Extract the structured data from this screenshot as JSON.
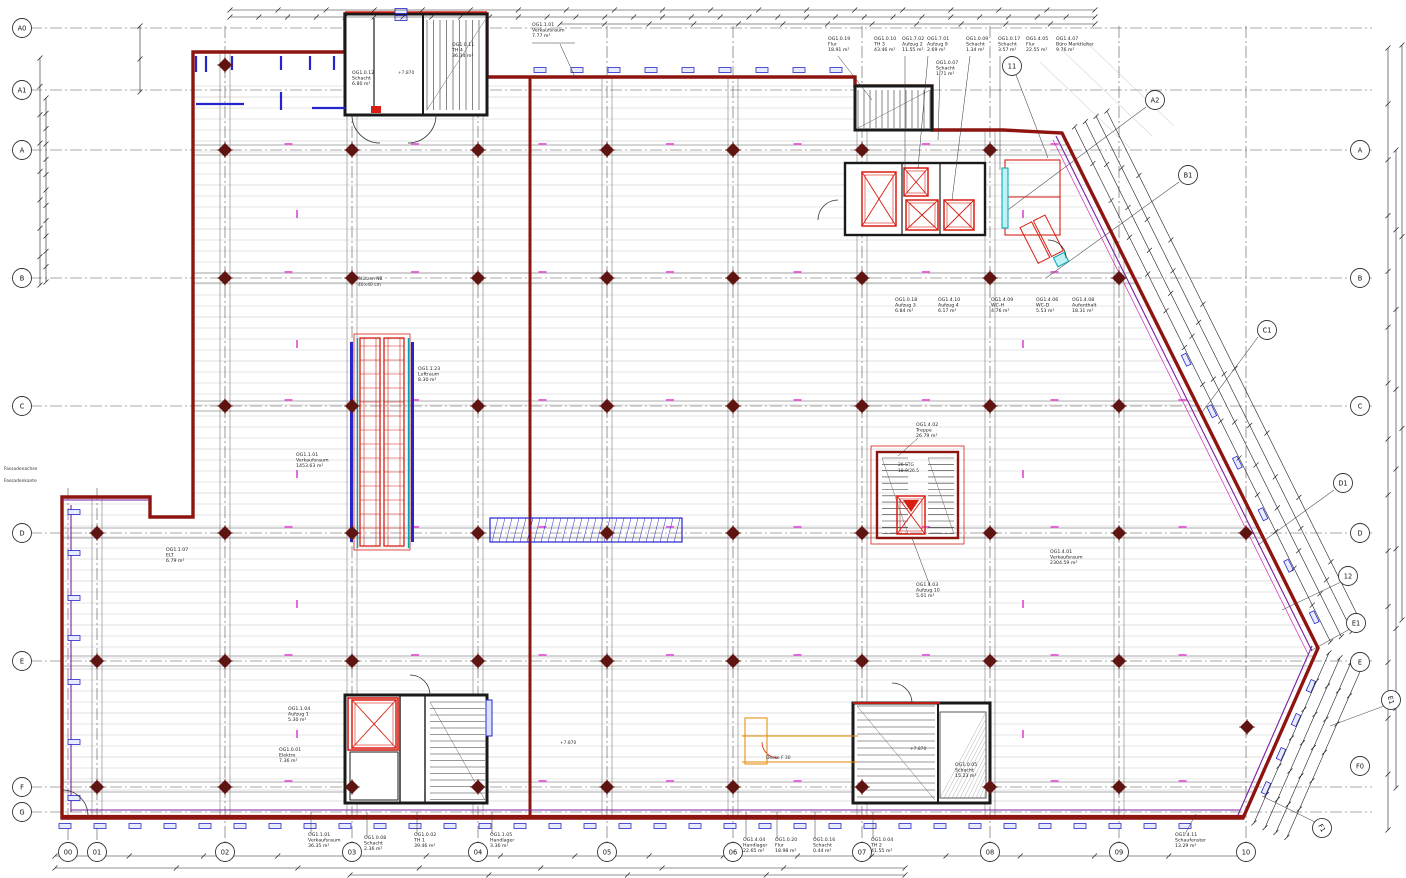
{
  "grid": {
    "left": [
      "A0",
      "A1",
      "A",
      "B",
      "C",
      "D",
      "E",
      "F",
      "G"
    ],
    "bottom": [
      "00",
      "01",
      "02",
      "03",
      "04",
      "05",
      "06",
      "07",
      "08",
      "09",
      "10"
    ],
    "right": [
      "A",
      "B",
      "C",
      "D",
      "E",
      "F0"
    ],
    "diag": [
      "A2",
      "B1",
      "C1",
      "D1",
      "12",
      "E1",
      "E1",
      "F1",
      "11"
    ]
  },
  "rooms": [
    {
      "id": "OG1.0.11",
      "name": "TH 4",
      "area": "36.34 m²"
    },
    {
      "id": "OG1.0.12",
      "name": "Schacht",
      "area": "6.80 m²"
    },
    {
      "id": "OG1.1.01",
      "name": "Verkaufsraum",
      "area": "7.77 m²"
    },
    {
      "id": "OG1.0.19",
      "name": "Flur",
      "area": "18.91 m²"
    },
    {
      "id": "OG1.0.10",
      "name": "TH 3",
      "area": "43.46 m²"
    },
    {
      "id": "OG1.7.02",
      "name": "Aufzug 2",
      "area": "11.55 m²"
    },
    {
      "id": "OG1.7.01",
      "name": "Aufzug 9",
      "area": "2.69 m²"
    },
    {
      "id": "OG1.0.07",
      "name": "Schacht",
      "area": "1.71 m²"
    },
    {
      "id": "OG1.0.09",
      "name": "Schacht",
      "area": "1.34 m²"
    },
    {
      "id": "OG1.0.17",
      "name": "Schacht",
      "area": "3.57 m²"
    },
    {
      "id": "OG1.4.05",
      "name": "Flur",
      "area": "22.55 m²"
    },
    {
      "id": "OG1.4.07",
      "name": "Büro Marktleiter",
      "area": "9.76 m²"
    },
    {
      "id": "OG1.0.18",
      "name": "Aufzug 3",
      "area": "6.84 m²"
    },
    {
      "id": "OG1.4.10",
      "name": "Aufzug 4",
      "area": "6.17 m²"
    },
    {
      "id": "OG1.4.09",
      "name": "WC-H",
      "area": "4.76 m²"
    },
    {
      "id": "OG1.4.06",
      "name": "WC-D",
      "area": "5.53 m²"
    },
    {
      "id": "OG1.4.08",
      "name": "Aufenthalt",
      "area": "18.31 m²"
    },
    {
      "id": "OG1.1.23",
      "name": "Luftraum",
      "area": "8.30 m²"
    },
    {
      "id": "OG1.1.01",
      "name": "Verkaufsraum",
      "area": "1453.63 m²"
    },
    {
      "id": "OG1.1.07",
      "name": "ELT",
      "area": "6.79 m²"
    },
    {
      "id": "OG1.4.02",
      "name": "Treppe",
      "area": "26.79 m²"
    },
    {
      "id": "OG1.4.03",
      "name": "Aufzug 10",
      "area": "5.01 m²"
    },
    {
      "id": "OG1.4.01",
      "name": "Verkaufsraum",
      "area": "2304.59 m²"
    },
    {
      "id": "OG1.1.04",
      "name": "Aufzug 1",
      "area": "5.30 m²"
    },
    {
      "id": "OG1.0.01",
      "name": "Elektro",
      "area": "7.36 m²"
    },
    {
      "id": "OG1.1.01",
      "name": "Verkaufsraum",
      "area": "36.35 m²"
    },
    {
      "id": "OG1.0.08",
      "name": "Schacht",
      "area": "2.36 m²"
    },
    {
      "id": "OG1.0.02",
      "name": "TH 1",
      "area": "39.46 m²"
    },
    {
      "id": "OG1.1.05",
      "name": "Handlager",
      "area": "3.36 m²"
    },
    {
      "id": "OG1.4.04",
      "name": "Handlager",
      "area": "22.65 m²"
    },
    {
      "id": "OG1.0.20",
      "name": "Flur",
      "area": "18.98 m²"
    },
    {
      "id": "OG1.0.16",
      "name": "Schacht",
      "area": "0.44 m²"
    },
    {
      "id": "OG1.0.04",
      "name": "TH 2",
      "area": "41.55 m²"
    },
    {
      "id": "OG1.0.05",
      "name": "Schacht",
      "area": "15.23 m²"
    },
    {
      "id": "OG1.4.11",
      "name": "Schaufenster",
      "area": "13.29 m²"
    }
  ],
  "notes": {
    "stair_mid_1": "26 STG",
    "stair_mid_2": "18.9/26.5",
    "level_th4": "+7.870",
    "level_th1": "+7.870",
    "level_th2": "+7.870",
    "decke": "Decke F 30",
    "stuetzen_1": "Stützen NB",
    "stuetzen_2": "40×40 cm",
    "fassade_1": "Fassadenachse",
    "fassade_2": "Fassadenkante"
  },
  "colors": {
    "wall": "#8e1410",
    "red": "#d81e14",
    "blue": "#2525cc",
    "magenta": "#e24fd8",
    "cyan": "#00a3ad",
    "purple": "#7a1fa2",
    "orange": "#e08a00",
    "black": "#1a1a1a",
    "grid": "#444444",
    "gray": "#c9c9c9"
  }
}
